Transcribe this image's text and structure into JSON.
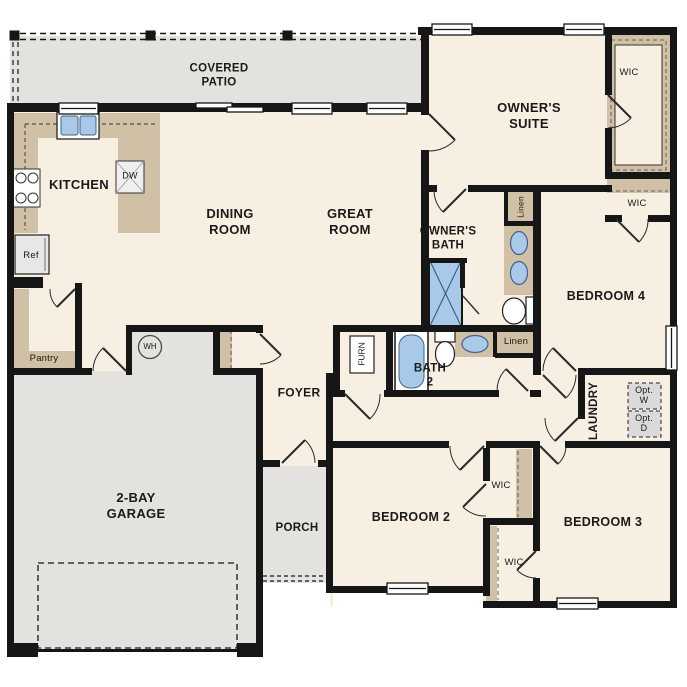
{
  "plan_title": "single-story house floor plan",
  "colors": {
    "floor": "#f7efe2",
    "concrete_gray": "#e3e2de",
    "cabinet_tan": "#cfc0a6",
    "fixture_blue": "#a9c9e9",
    "wall_black": "#161616",
    "appliance_gray": "#dadada"
  },
  "labels": {
    "covered_patio": "COVERED\nPATIO",
    "kitchen": "KITCHEN",
    "dining_room": "DINING\nROOM",
    "great_room": "GREAT\nROOM",
    "owners_suite": "OWNER'S\nSUITE",
    "owners_bath": "OWNER'S\nBATH",
    "bath_2": "BATH\n2",
    "bedroom_2": "BEDROOM 2",
    "bedroom_3": "BEDROOM 3",
    "bedroom_4": "BEDROOM 4",
    "foyer": "FOYER",
    "porch": "PORCH",
    "garage": "2-BAY\nGARAGE",
    "laundry": "LAUNDRY",
    "wic_owner": "WIC",
    "wic_bed4": "WIC",
    "wic_bed2": "WIC",
    "wic_bed3": "WIC",
    "linen_owner": "Linen",
    "linen_bath": "Linen",
    "pantry": "Pantry",
    "refrigerator": "Ref",
    "dishwasher": "DW",
    "water_heater": "WH",
    "furnace": "FURN",
    "opt_washer": "Opt.\nW",
    "opt_dryer": "Opt.\nD"
  }
}
